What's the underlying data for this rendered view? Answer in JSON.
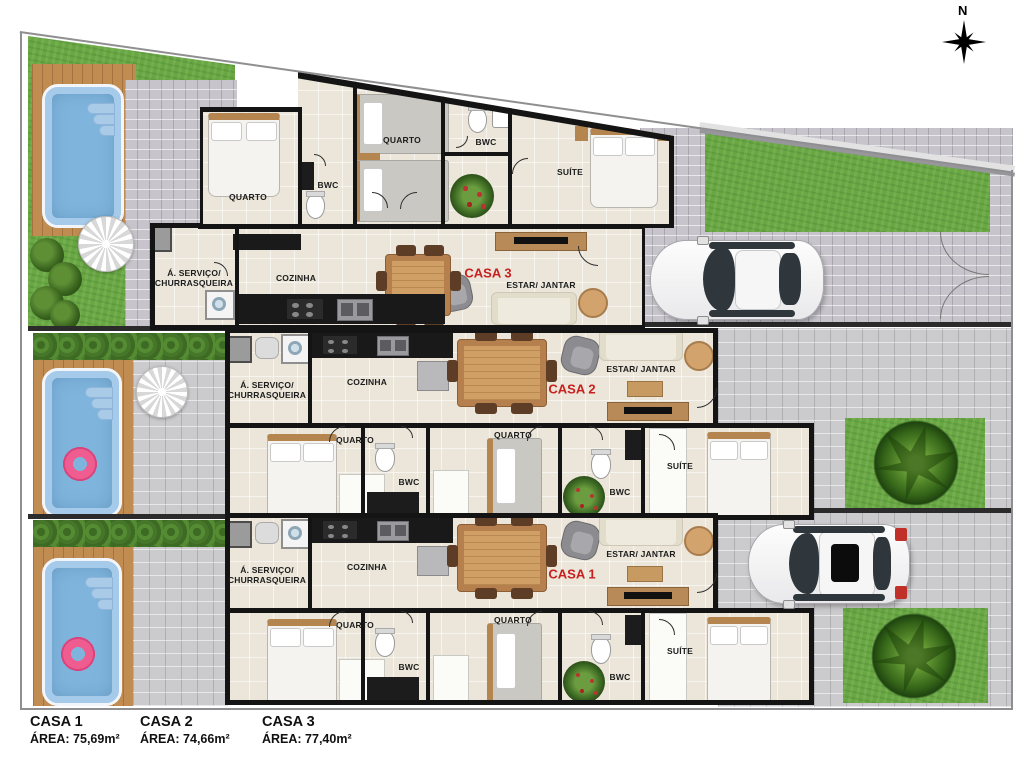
{
  "compass": {
    "north_label": "N"
  },
  "legend": {
    "items": [
      {
        "name": "CASA 1",
        "area": "ÁREA: 75,69m²"
      },
      {
        "name": "CASA 2",
        "area": "ÁREA: 74,66m²"
      },
      {
        "name": "CASA 3",
        "area": "ÁREA: 77,40m²"
      }
    ]
  },
  "houses": {
    "casa3": {
      "name": "CASA 3",
      "rooms": {
        "quarto_a": "QUARTO",
        "bwc_a": "BWC",
        "quarto_b": "QUARTO",
        "bwc_b": "BWC",
        "suite": "SUÍTE",
        "servico": "Á. SERVIÇO/\nCHURRASQUEIRA",
        "cozinha": "COZINHA",
        "estar_jantar": "ESTAR/ JANTAR"
      }
    },
    "casa2": {
      "name": "CASA 2",
      "rooms": {
        "servico": "Á. SERVIÇO/\nCHURRASQUEIRA",
        "cozinha": "COZINHA",
        "estar_jantar": "ESTAR/ JANTAR",
        "quarto_a": "QUARTO",
        "bwc_a": "BWC",
        "quarto_b": "QUARTO",
        "bwc_b": "BWC",
        "suite": "SUÍTE"
      }
    },
    "casa1": {
      "name": "CASA 1",
      "rooms": {
        "servico": "Á. SERVIÇO/\nCHURRASQUEIRA",
        "cozinha": "COZINHA",
        "estar_jantar": "ESTAR/ JANTAR",
        "quarto_a": "QUARTO",
        "bwc_a": "BWC",
        "quarto_b": "QUARTO",
        "bwc_b": "BWC",
        "suite": "SUÍTE"
      }
    }
  },
  "colors": {
    "accent_red": "#C8201F",
    "wall": "#141414",
    "floor": "#EBE6D9",
    "grass": "#68A742",
    "water": "#7FB5DD",
    "paver": "#CBCACD",
    "deck": "#C18C52"
  }
}
